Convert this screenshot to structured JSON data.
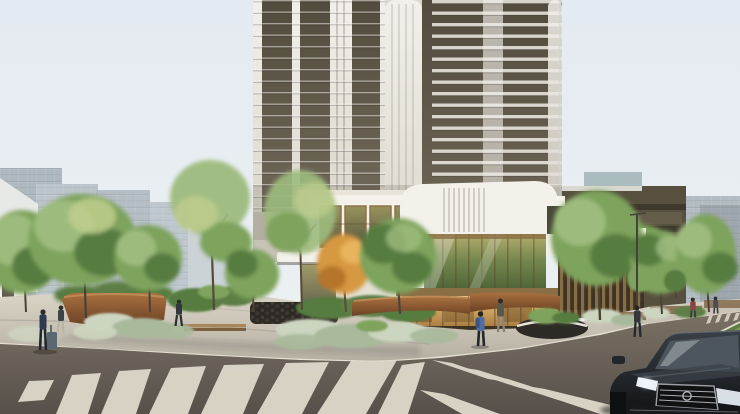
{
  "meta": {
    "image_type": "architectural rendering",
    "description": "Street-corner view of a modern high-rise residential tower with a white retail podium, landscaped plaza with corten planters and silver shrubs, zebra crosswalks meeting at a chevron, pedestrians, and a dark sedan at bottom right"
  },
  "colors": {
    "sky1": "#e4eaf1",
    "sky2": "#eaeff2",
    "sky3": "#f0f2f2",
    "bgbld1": "#aeb8bf",
    "bgbld2": "#bcc5cb",
    "bgbld3": "#c8cfd3",
    "bgwhite": "#e7e9e7",
    "slabR": "#b2bcc1",
    "bronzeBld": "#57503e",
    "bronzeBand": "#3f392c",
    "bronzeLight": "#6a6350",
    "towerWhite1": "#f2f0ea",
    "towerWhite2": "#dcd8cd",
    "towerDark1": "#524c3e",
    "towerDark2": "#6f6859",
    "podWhite": "#f3f1ea",
    "podShade": "#ddd8cc",
    "cornice": "#e8e4d9",
    "olive1": "#99935f",
    "olive2": "#55563c",
    "curt1": "#b3ad6e",
    "curt2": "#75874e",
    "curt3": "#4c6236",
    "bronze": "#8a6f44",
    "bronzeDark": "#5f4b2e",
    "storeDark": "#3e3322",
    "store1": "#efc37a",
    "store2": "#a3763a",
    "treeL": "#9dbb7d",
    "treeM": "#7da35c",
    "treeD": "#567c41",
    "treeY": "#c2cf8e",
    "treeO": "#d6983f",
    "treeOD": "#b5742c",
    "silver1": "#ccd5bf",
    "silver2": "#a9b99b",
    "shrubG": "#5d7f46",
    "rust1": "#aa7140",
    "rust2": "#6b4124",
    "rustTop": "#bd8a55",
    "gabion": "#2d2a25",
    "gabionDot": "#4e483d",
    "wood": "#a8855c",
    "woodD": "#7c5f3e",
    "pave1": "#dcd6c9",
    "pave2": "#b5afa2",
    "curb": "#e6e0d2",
    "road1": "#7a7164",
    "road2": "#57504a",
    "stripe": "#ded9cb",
    "grass1": "#7d9a57",
    "grass2": "#5e7b42",
    "carBody1": "#3a4047",
    "carBody2": "#101214",
    "carGlass": "#4d565e",
    "chrome": "#c3c8cd",
    "headlight": "#e9f0f6",
    "poleDark": "#44423c",
    "poleLight": "#dad5c8",
    "skin": "#c9a57f",
    "pNavy": "#2e3a52",
    "pBlue": "#4d6da3",
    "pBlueDark": "#3a5583",
    "pGray": "#3c4248",
    "pOlive": "#555a50",
    "pMaroon": "#8a4444",
    "pDark": "#33373c",
    "pPantsLight": "#b9b3a6",
    "luggage": "#5a6672"
  },
  "scene": {
    "labels": {
      "root": "architectural rendering of residential tower at street corner",
      "sky": "pale morning sky",
      "bgLeft": "distant gray office buildings behind trees, left",
      "bgRight": "bronze terraced building with planted balconies and gray slab, right",
      "tower": "high-rise tower with vertical white mullions and dark glazing",
      "podium": "white retail podium with green-gold curtain wall",
      "storefront": "amber lit ground-floor storefront with bronze mullions",
      "plaza": "landscaped plaza with corten planters, stone walls and silver shrubs",
      "trees": "street and plaza trees",
      "pavement": "light stone plaza pavement",
      "road": "asphalt road at intersection corner",
      "crosswalkLeft": "zebra crosswalk, left street",
      "crosswalkRight": "zebra crosswalk, right street",
      "median": "planted grass median",
      "car": "dark sedan with chrome grille and lit headlights",
      "pedestrians": "pedestrians walking through plaza and sidewalks"
    },
    "counts": {
      "towers": 1,
      "trees": 13,
      "pedestrians": 8,
      "cars": 1,
      "crosswalk_stripes_left": 9,
      "crosswalk_stripes_right": 5
    }
  }
}
